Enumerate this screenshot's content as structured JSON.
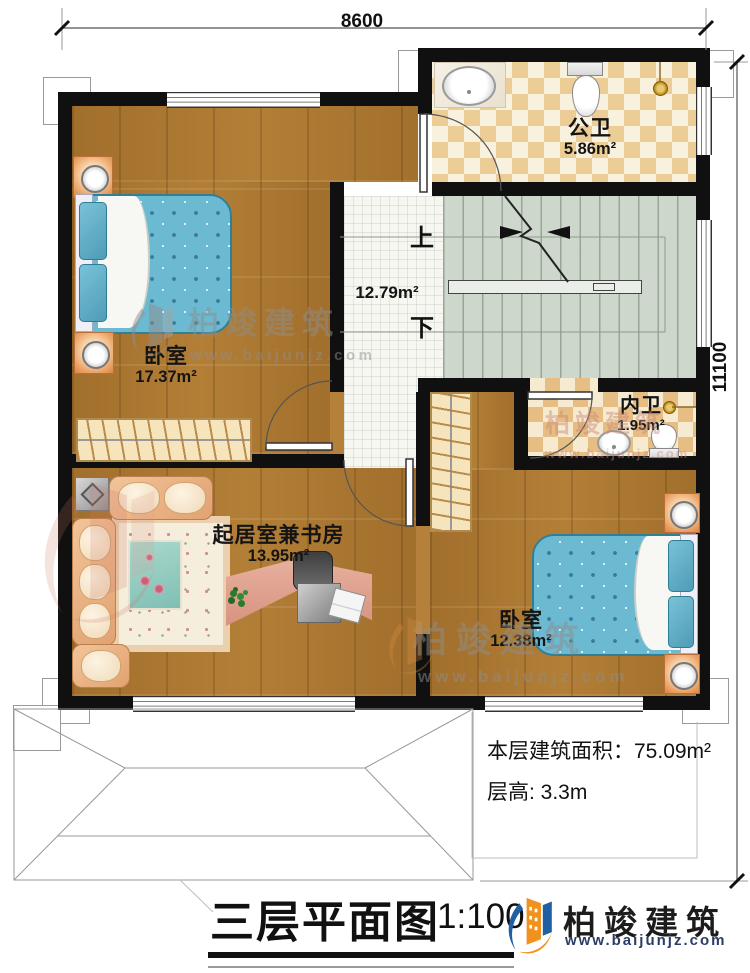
{
  "dimensions": {
    "width": "8600",
    "depth": "11100"
  },
  "rooms": {
    "public_bath": {
      "name": "公卫",
      "area": "5.86m²"
    },
    "bedroom_left": {
      "name": "卧室",
      "area": "17.37m²"
    },
    "hall": {
      "area": "12.79m²"
    },
    "ensuite_bath": {
      "name": "内卫",
      "area": "1.95m²"
    },
    "living_study": {
      "name": "起居室兼书房",
      "area": "13.95m²"
    },
    "bedroom_right": {
      "name": "卧室",
      "area": "12.38m²"
    }
  },
  "stairs": {
    "up_label": "上",
    "down_label": "下"
  },
  "annotations": {
    "floor_area": "本层建筑面积：75.09m²",
    "floor_height": "层高: 3.3m"
  },
  "title": {
    "text": "三层平面图",
    "scale": "1:100"
  },
  "brand": {
    "name": "柏竣建筑",
    "url": "www.baijunjz.com"
  },
  "watermark": {
    "name": "柏竣建筑",
    "url": "www.baijunjz.com"
  },
  "colors": {
    "wall": "#111111",
    "wood_floor": "#ad7a33",
    "stair_floor": "#ced8cb",
    "tile_checker": "#eccd96",
    "bed": "#6cb9d2",
    "brand_blue": "#1f5fa2",
    "brand_orange": "#f0921e"
  }
}
